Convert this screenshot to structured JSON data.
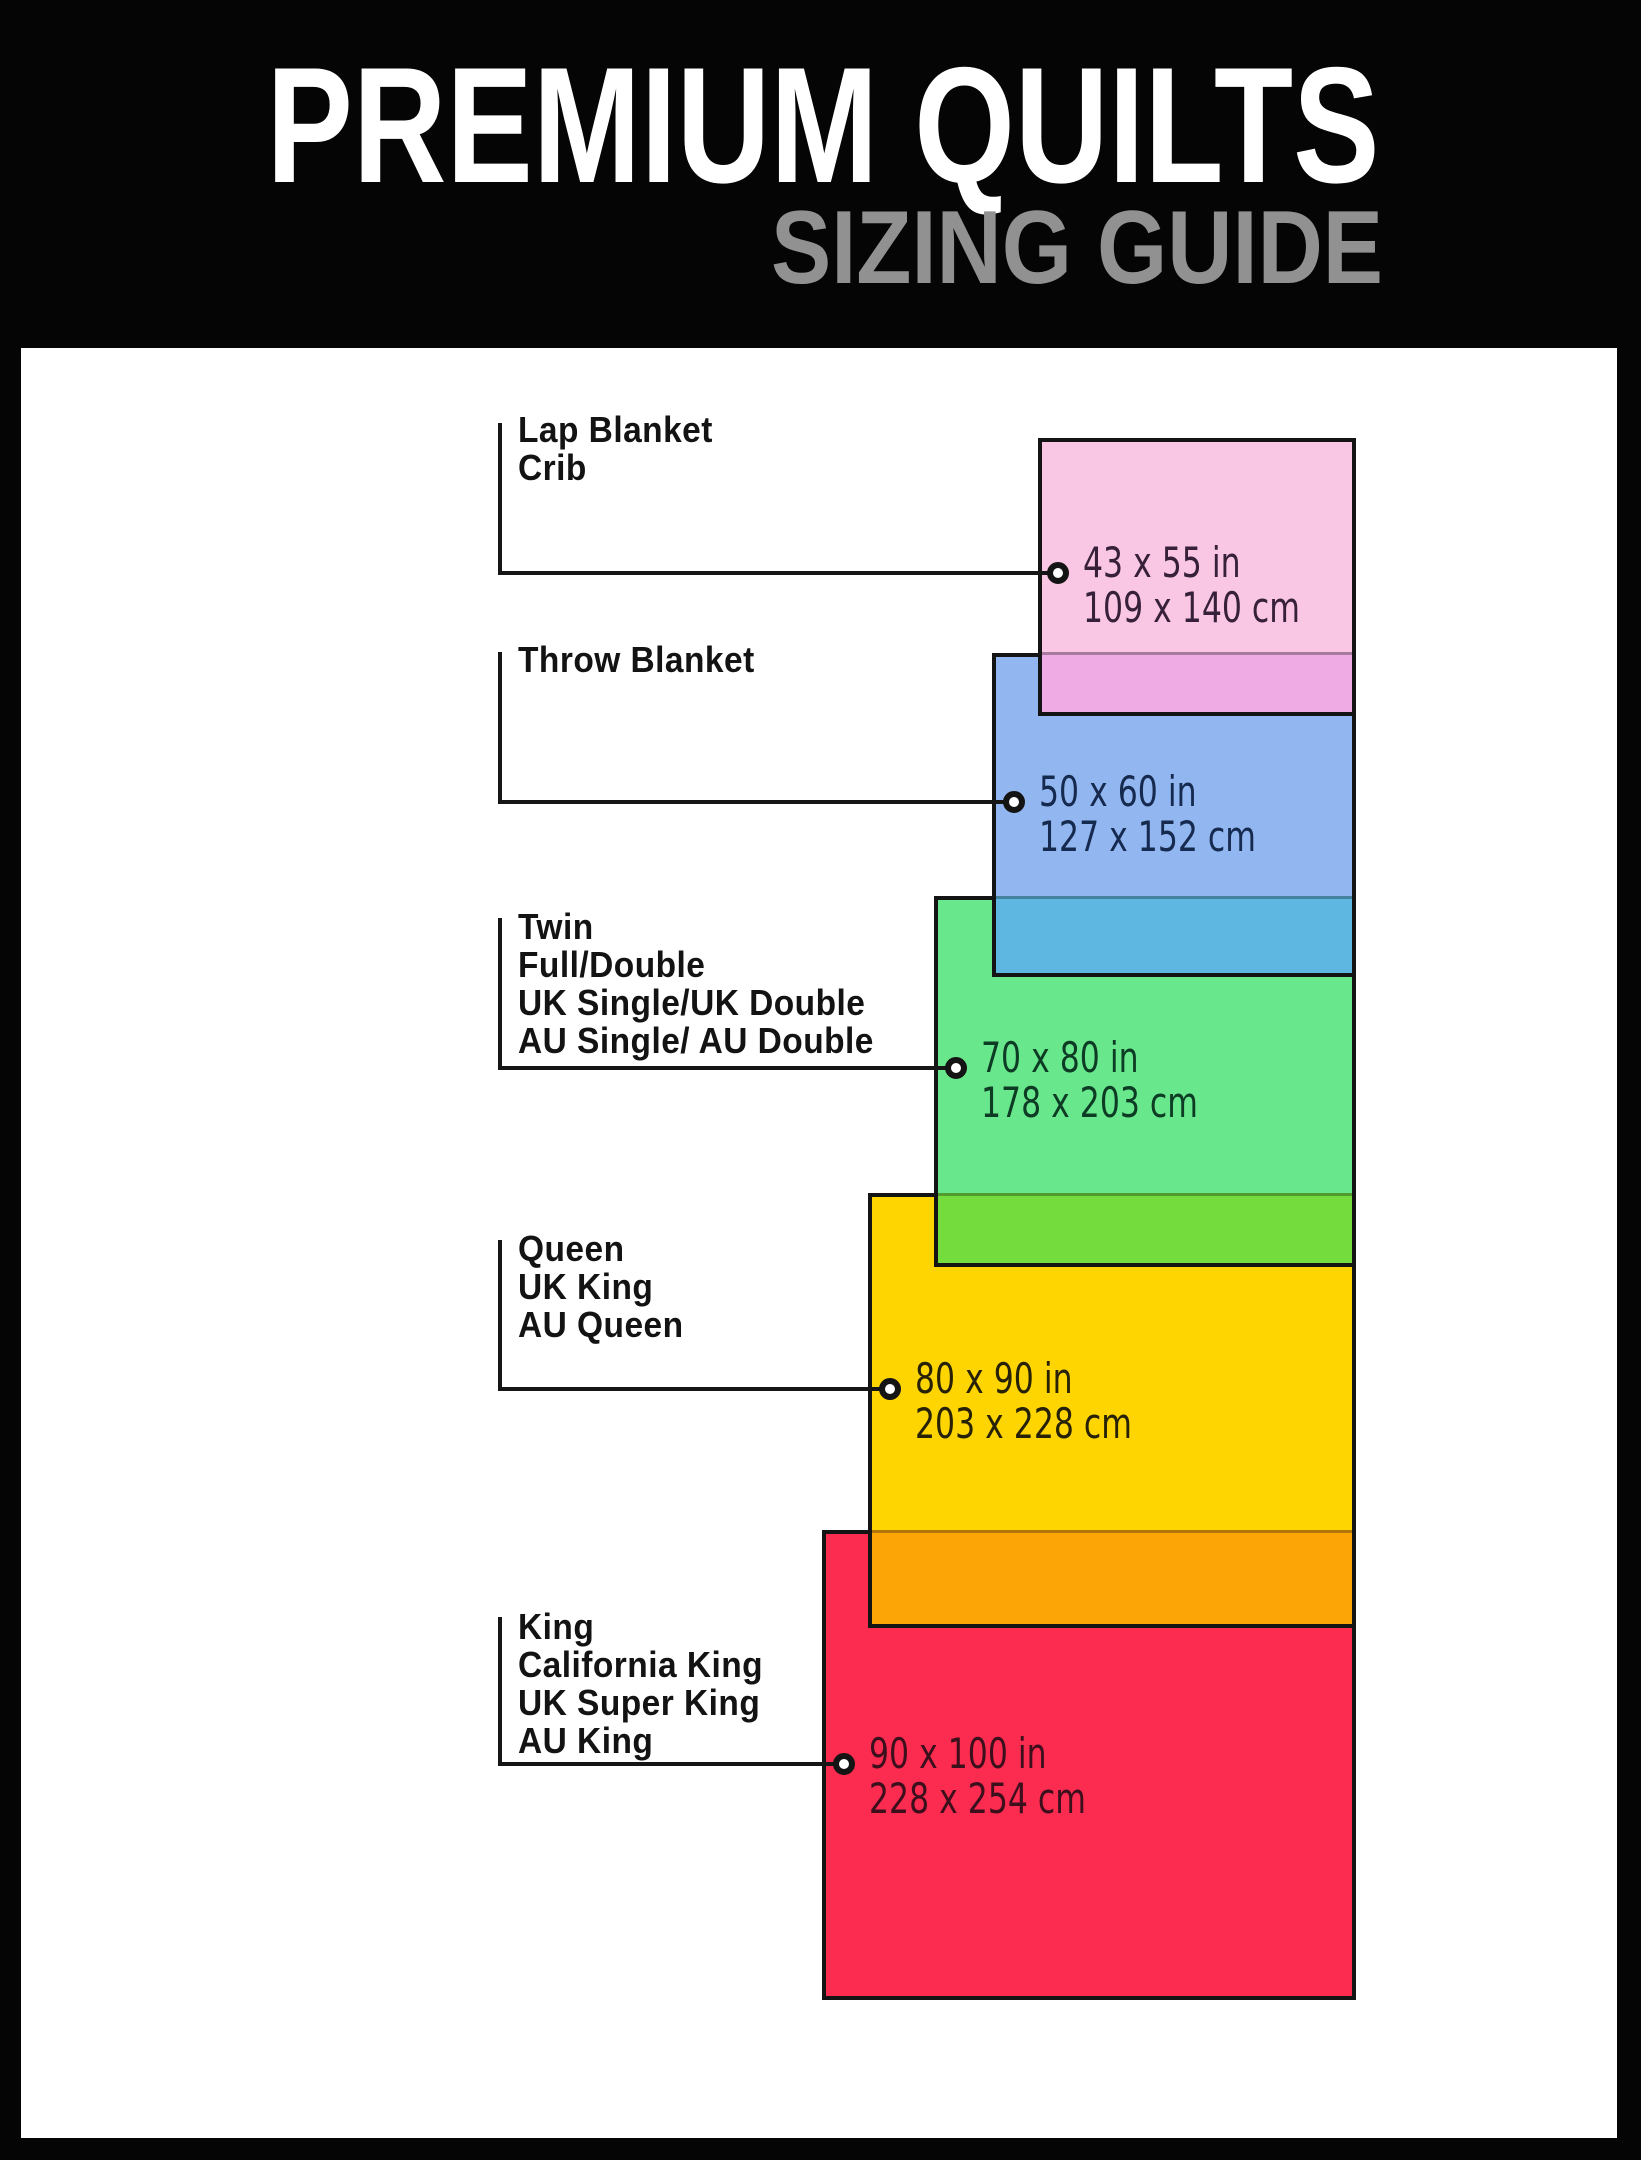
{
  "header": {
    "title": "PREMIUM QUILTS",
    "subtitle": "SIZING GUIDE"
  },
  "colors": {
    "frame": "#050505",
    "canvas": "#ffffff",
    "line": "#141414",
    "title": "#ffffff",
    "subtitle": "#919191",
    "label_text": "#131313"
  },
  "sizes": [
    {
      "id": "lap-blanket-crib",
      "label_lines": [
        "Lap Blanket",
        "Crib"
      ],
      "inches": "43 x 55 in",
      "cm": "109 x 140 cm",
      "fill": "#f9c6e3",
      "overlap_fill": "#efabe3",
      "text_color": "#372039"
    },
    {
      "id": "throw-blanket",
      "label_lines": [
        "Throw Blanket"
      ],
      "inches": "50 x 60 in",
      "cm": "127 x 152 cm",
      "fill": "#92b7f0",
      "overlap_fill": "#5db7e0",
      "text_color": "#16294e"
    },
    {
      "id": "twin",
      "label_lines": [
        "Twin",
        "Full/Double",
        "UK Single/UK Double",
        "AU Single/ AU Double"
      ],
      "inches": "70 x 80 in",
      "cm": "178 x 203 cm",
      "fill": "#68e78c",
      "overlap_fill": "#74dc3d",
      "text_color": "#0d3b24"
    },
    {
      "id": "queen",
      "label_lines": [
        "Queen",
        "UK King",
        "AU Queen"
      ],
      "inches": "80 x 90 in",
      "cm": "203 x 228 cm",
      "fill": "#ffd501",
      "overlap_fill": "#fba507",
      "text_color": "#272105"
    },
    {
      "id": "king",
      "label_lines": [
        "King",
        "California King",
        "UK Super King",
        "AU King"
      ],
      "inches": "90 x 100 in",
      "cm": "228 x 254 cm",
      "fill": "#fc2b50",
      "overlap_fill": null,
      "text_color": "#3c0f1d"
    }
  ]
}
